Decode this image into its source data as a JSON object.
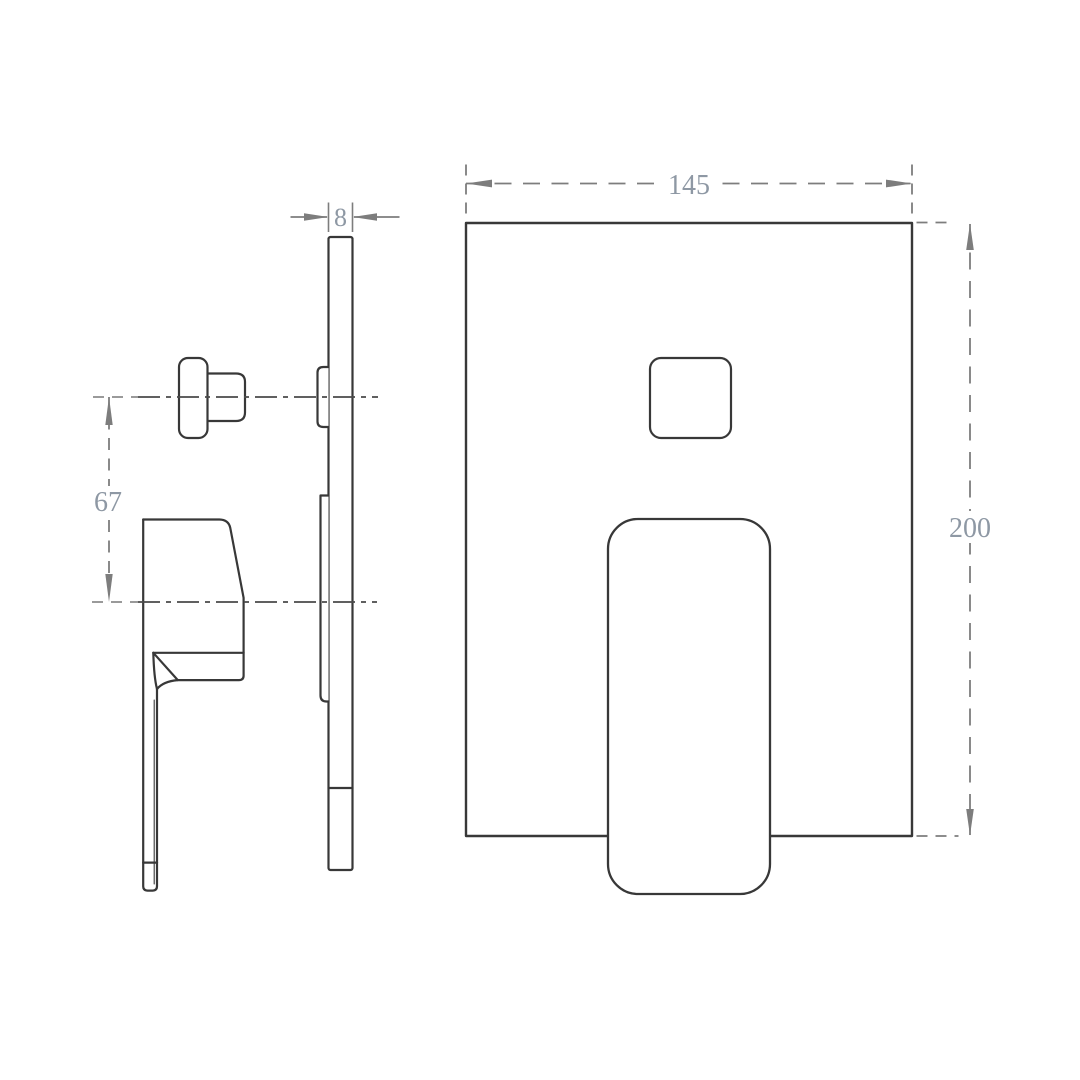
{
  "drawing": {
    "title": "concealed-shower-mixer-technical-drawing",
    "views": {
      "side_view": {
        "name": "side-profile-section-view"
      },
      "front_view": {
        "name": "front-elevation-view"
      }
    },
    "dimensions": {
      "plate_thickness": {
        "value": "8"
      },
      "handle_to_diverter_offset": {
        "value": "67"
      },
      "plate_width": {
        "value": "145"
      },
      "plate_height": {
        "value": "200"
      }
    },
    "colors": {
      "background": "#ffffff",
      "outline": "#383838",
      "dimension_line": "#7d7d7d",
      "dimension_text": "#8e98a4",
      "centerline": "#4a4a4a"
    }
  }
}
